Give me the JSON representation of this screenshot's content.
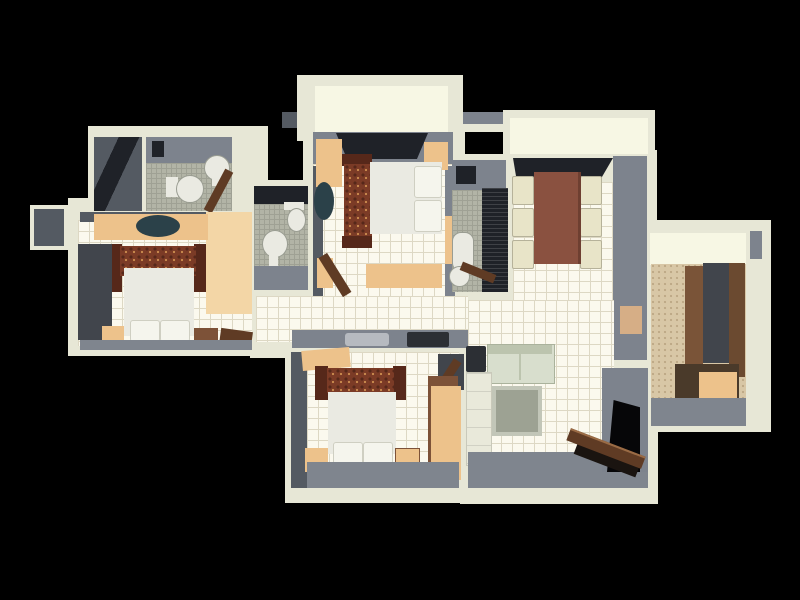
{
  "scene": {
    "type": "3d-floor-plan-render",
    "view": "top-down",
    "background": "#000000",
    "description": "Photorealistic 3D top-down render of a three-bedroom apartment floor plan centered on a black background"
  },
  "palette": {
    "bg": "#000000",
    "wall": "#e7e7d6",
    "wall_bright": "#f7f7e4",
    "tile": "#fbf9ee",
    "tile_line": "#ddd8c4",
    "gray_wall": "#7d838d",
    "gray_dark": "#545a62",
    "gray_floor": "#7f858e",
    "window_dark": "#1f2228",
    "mosaic": "#b2b4a6",
    "mosaic_line": "#9fa194",
    "peach": "#edc28b",
    "peach_light": "#f3d6a6",
    "peach_muted": "#d6ae86",
    "rug": "#7b3b26",
    "rug_dark": "#56281a",
    "rug_gold": "#c98a4e",
    "bed": "#eaeae2",
    "pillow": "#f5f5ed",
    "wood": "#7d5238",
    "wood2": "#7a5438",
    "wood3": "#6b4a30",
    "chest": "#4a3a2a",
    "door_brown": "#5f3b24",
    "sofa": "#d8decd",
    "sofa_dark": "#bcc4ae",
    "table_brown": "#8a5140",
    "chair": "#e8e4c8",
    "chair_line": "#b6b29a",
    "coffee": "#9da293",
    "coffee_rim": "#c2c6b8",
    "wardrobe_dark": "#41454c",
    "carpet": "#d8c7a6",
    "counter": "#e9e9da",
    "sink_light": "#b6bac0",
    "hob_dark": "#2c2f34",
    "fan_teal": "#2b4149"
  },
  "rooms": [
    {
      "name": "top-balcony",
      "furniture": []
    },
    {
      "name": "master-bedroom",
      "furniture": [
        "double-bed",
        "ornate-runner-rug",
        "pillows",
        "dresser",
        "nightstands",
        "ceiling-fan",
        "open-door",
        "window-band"
      ]
    },
    {
      "name": "bathroom-top-left",
      "furniture": [
        "toilet",
        "wash-basin",
        "door"
      ]
    },
    {
      "name": "store-room",
      "furniture": []
    },
    {
      "name": "left-bedroom",
      "furniture": [
        "double-bed",
        "ornate-headboard-rug",
        "pillows",
        "sliding-wardrobe",
        "nightstands",
        "ceiling-fan",
        "dresser",
        "bench"
      ]
    },
    {
      "name": "middle-bathroom",
      "furniture": [
        "toilet",
        "pedestal-basin",
        "window-band"
      ]
    },
    {
      "name": "ensuite-bathroom",
      "furniture": [
        "bathtub",
        "shower-panel",
        "washer",
        "open-door"
      ]
    },
    {
      "name": "kitchen-balcony",
      "furniture": []
    },
    {
      "name": "dining-room",
      "furniture": [
        "dining-table",
        "chairs-x6",
        "dark-counter",
        "wall-art"
      ]
    },
    {
      "name": "living-kitchen",
      "furniture": [
        "sofa",
        "side-table",
        "coffee-table",
        "kitchen-counter",
        "sink",
        "hob",
        "entrance-door"
      ]
    },
    {
      "name": "bottom-bedroom",
      "furniture": [
        "double-bed",
        "ornate-headboard-rug",
        "pillows",
        "wardrobe",
        "nightstands",
        "shelf"
      ]
    },
    {
      "name": "utility-dressing-room",
      "furniture": [
        "wardrobe-cabinets",
        "storage-chest"
      ]
    },
    {
      "name": "service-shaft",
      "furniture": []
    }
  ]
}
